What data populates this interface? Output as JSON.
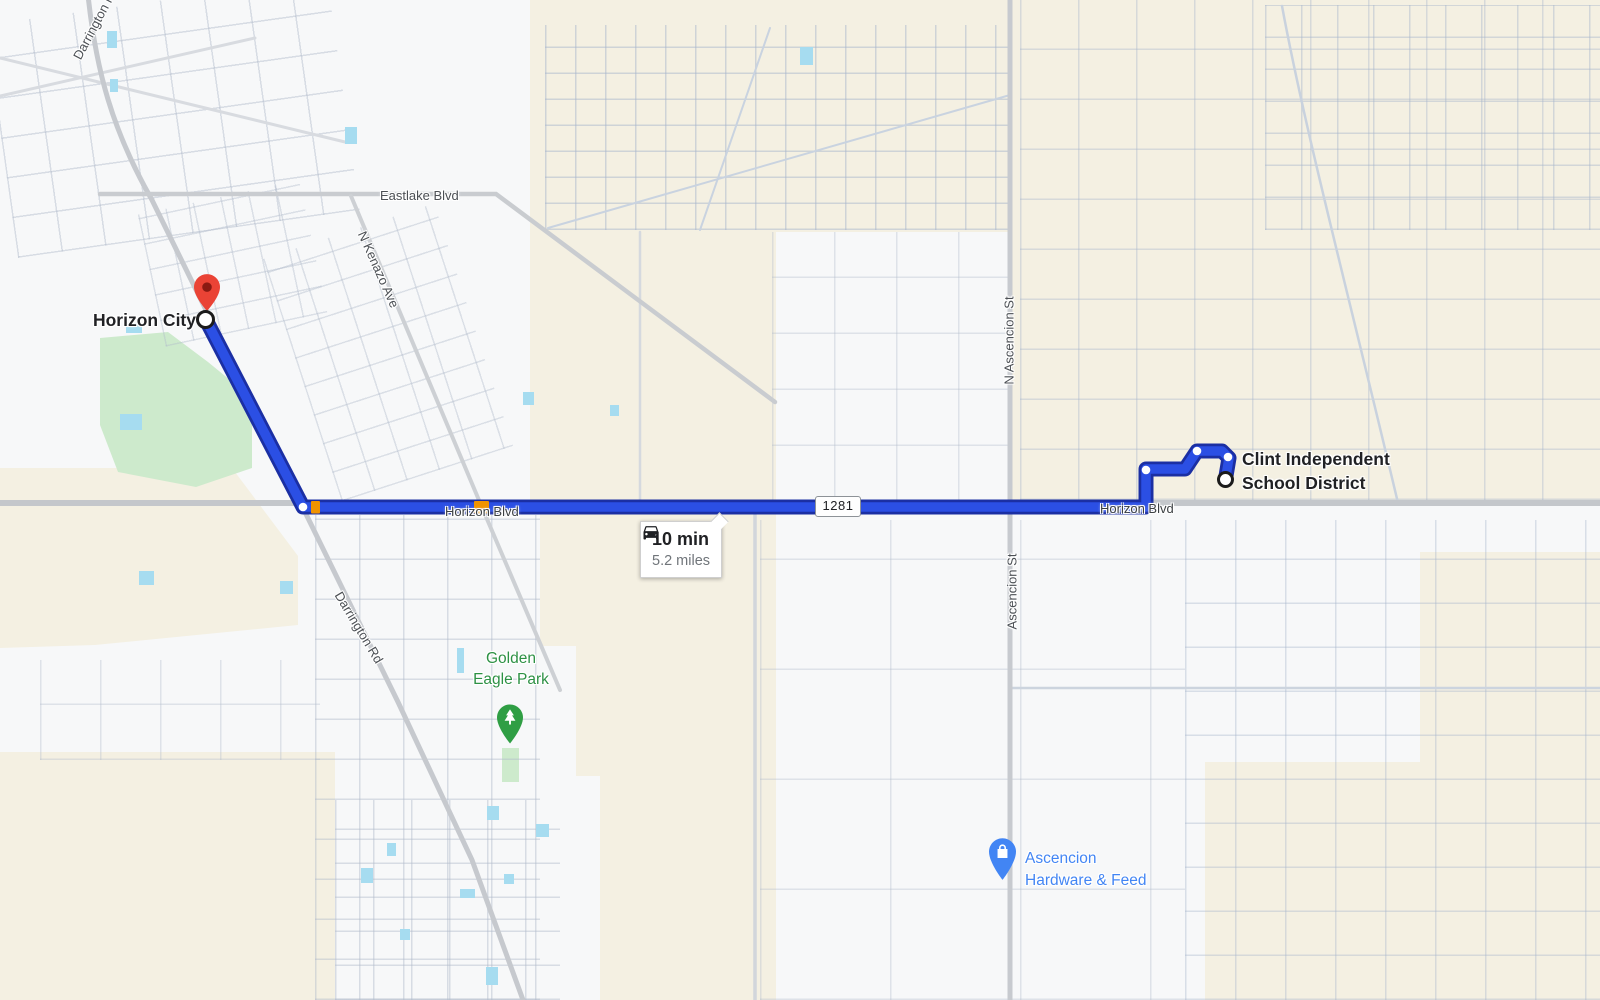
{
  "labels": {
    "origin": "Horizon City",
    "destination": [
      "Clint Independent",
      "School District"
    ],
    "park": [
      "Golden",
      "Eagle Park"
    ],
    "store": [
      "Ascencion",
      "Hardware & Feed"
    ]
  },
  "route": {
    "duration": "10 min",
    "distance": "5.2 miles",
    "shield": "1281"
  },
  "roads": {
    "eastlake": "Eastlake Blvd",
    "kenazo": "N Kenazo Ave",
    "horizon_west": "Horizon Blvd",
    "horizon_east": "Horizon Blvd",
    "n_ascencion": "N Ascencion St",
    "ascencion": "Ascencion St",
    "darrington": "Darrington Rd",
    "darrington_top": "Darrington Rd"
  },
  "icons": {
    "tooltip_icon": "car-icon",
    "origin_icon": "red-pin-icon",
    "origin_point": "origin-ring-icon",
    "destination_point": "destination-ring-icon",
    "park_icon": "tree-pin-icon",
    "store_icon": "shopping-bag-pin-icon"
  },
  "colors": {
    "route_fill": "#2b4fe4",
    "route_casing": "#1b2fa3",
    "traffic_orange": "#f09300",
    "terrain_beige": "#f4f0e2",
    "park_green": "#cdeacc",
    "water_blue": "#a6dcf0",
    "park_pin_green": "#2f9e44",
    "store_pin_blue": "#4285f4",
    "origin_pin_red": "#ea4335",
    "road_gray": "#c6c9ce"
  }
}
